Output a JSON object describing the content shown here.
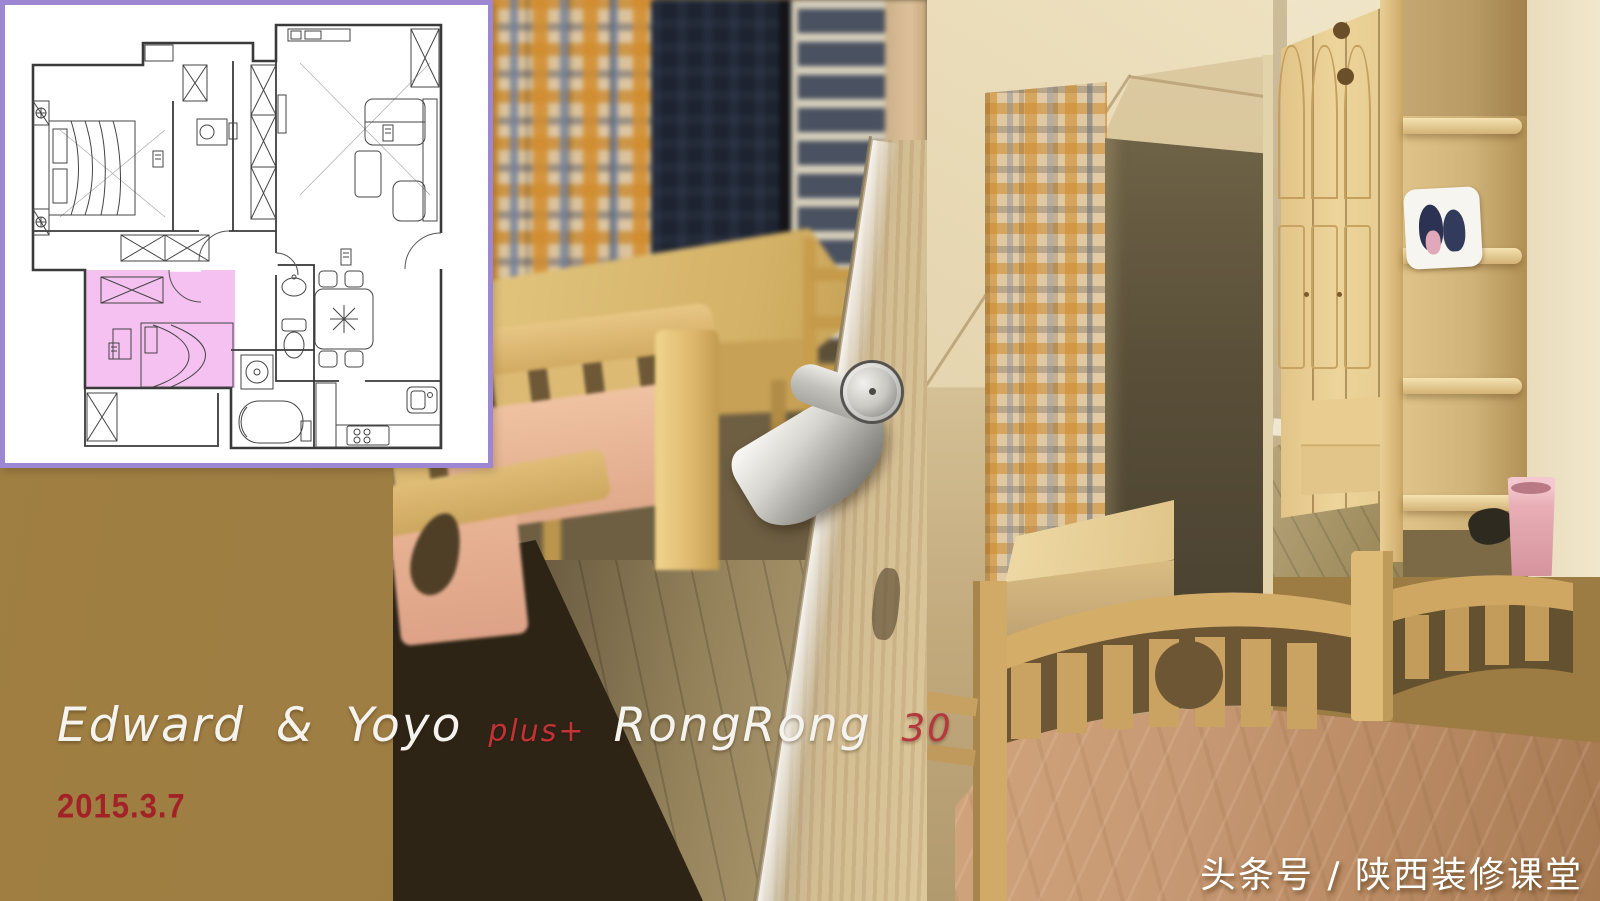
{
  "overlay_text": {
    "names_primary": "Edward & Yoyo",
    "plus": "plus+",
    "names_secondary": "RongRong",
    "number": "30",
    "date": "2015.3.7",
    "watermark": "头条号 / 陕西装修课堂"
  },
  "colors": {
    "background_brown": "#9D7C44",
    "plan_frame_purple": "#9E87D2",
    "plan_highlight_pink": "#F2B6EE",
    "title_white": "#F5F3EE",
    "accent_red": "#C23236",
    "date_red": "#A22327",
    "watermark_white": "#FFFFFF",
    "pine_wood": "#E0BE76",
    "mattress_pink": "#E7B296",
    "trash_bin_pink": "#E8AEB6"
  },
  "collage": {
    "floor_plan": {
      "content": "apartment-floor-plan",
      "highlighted_room": "child-bedroom-bottom-left"
    },
    "photos": [
      {
        "name": "child-room-desk-window-and-door-handle"
      },
      {
        "name": "curtained-alcove-with-low-cabinet"
      },
      {
        "name": "pine-wardrobe-and-corner-shelf"
      },
      {
        "name": "pine-bed-with-pink-bedding-tinted"
      }
    ]
  }
}
